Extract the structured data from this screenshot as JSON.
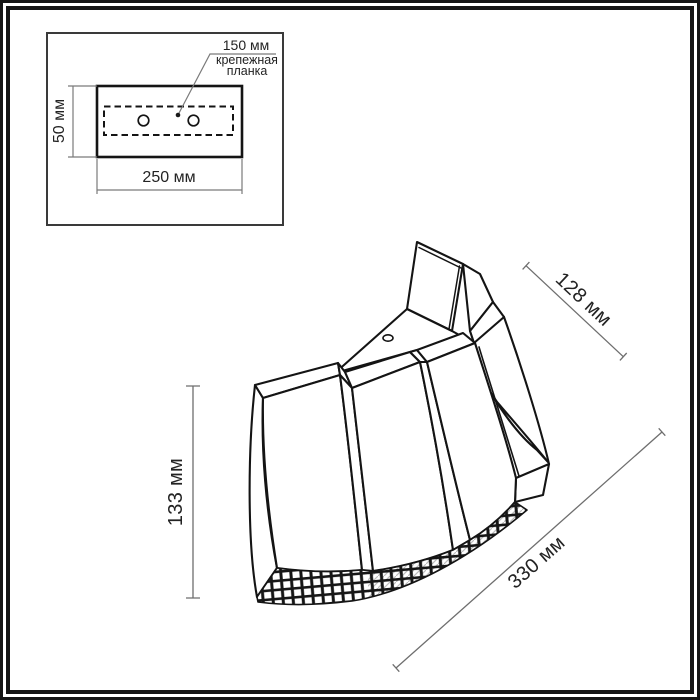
{
  "inset_diagram": {
    "bracket_callout": {
      "dimension_label": "150 мм",
      "name_line1": "крепежная",
      "name_line2": "планка"
    },
    "height_dimension": "50 мм",
    "width_dimension": "250 мм"
  },
  "main_diagram": {
    "depth_dimension": "128 мм",
    "height_dimension": "133 мм",
    "width_dimension": "330 мм"
  },
  "colors": {
    "outline": "#1a1a1a",
    "dimension_line": "#6e6e6e",
    "background": "#ffffff"
  }
}
